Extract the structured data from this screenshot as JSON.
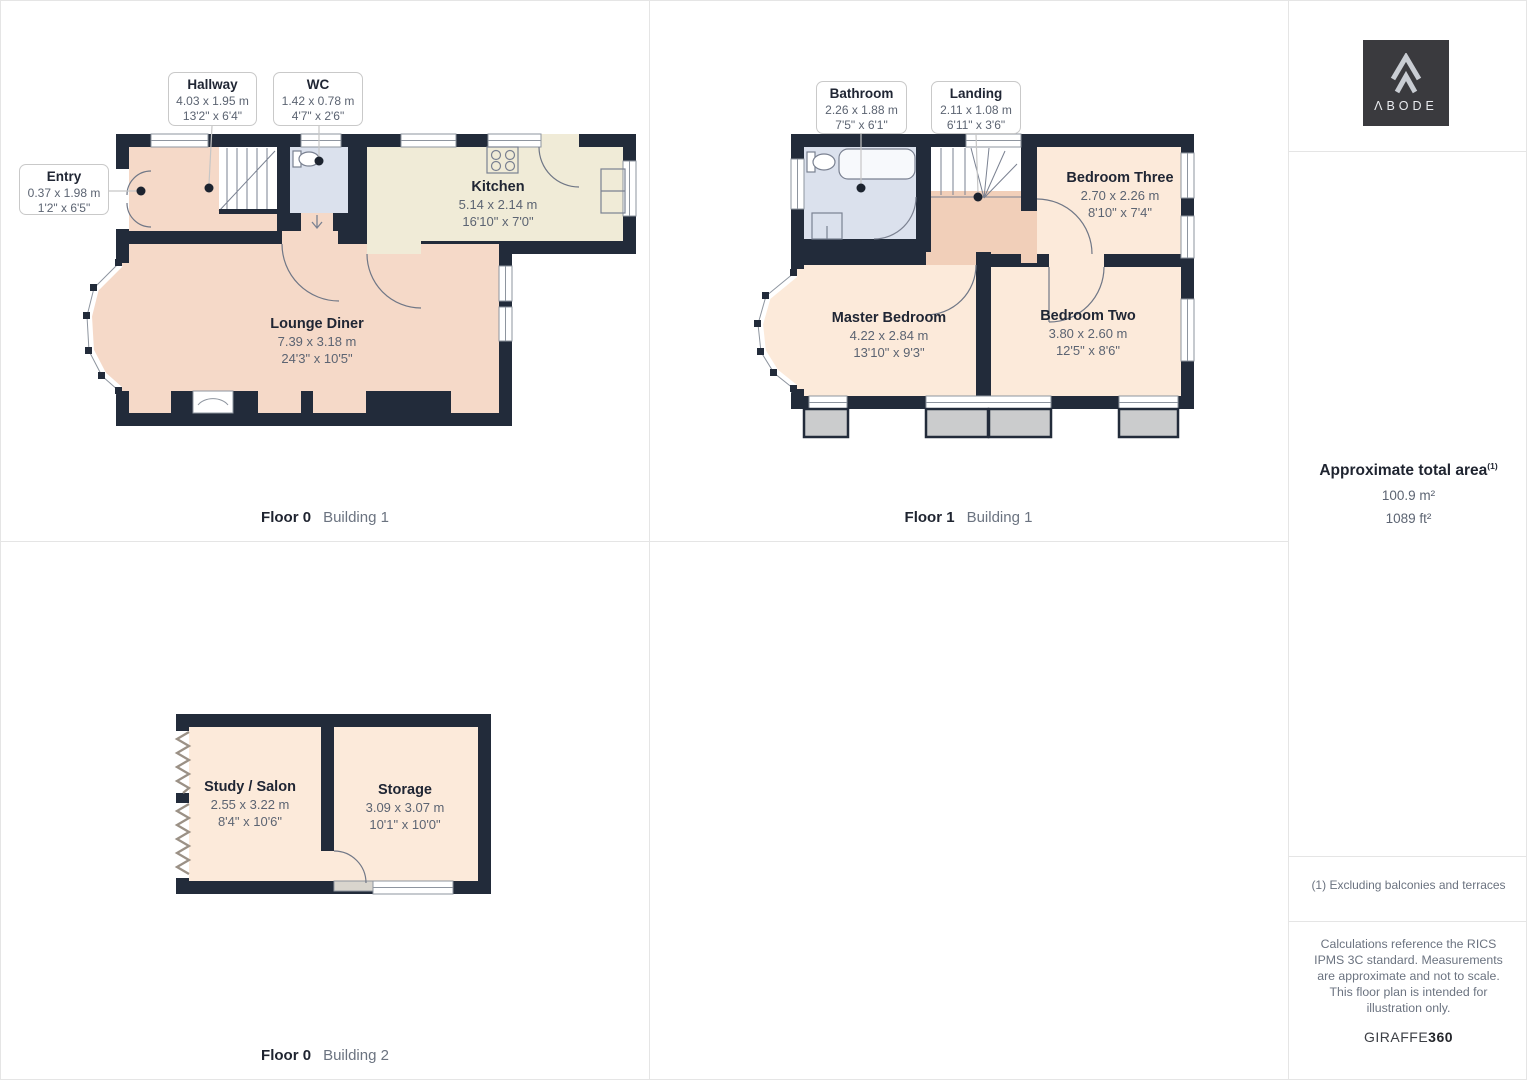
{
  "page": {
    "background": "#ffffff",
    "grid_color": "#e5e5e5"
  },
  "colors": {
    "wall": "#222b3a",
    "room_warm": "#f5d9c8",
    "room_cream": "#f0ebd7",
    "room_bedroom": "#fceada",
    "room_wet": "#dbe1ed",
    "landing": "#f1cfb9",
    "roof_grey": "#cbcccd"
  },
  "branding": {
    "logo_text": "ΛBODE",
    "footer_brand": "GIRAFFE",
    "footer_brand_bold": "360"
  },
  "sidebar": {
    "area_title": "Approximate total area",
    "area_superscript": "(1)",
    "area_m2": "100.9 m²",
    "area_ft2": "1089 ft²",
    "footnote": "(1) Excluding balconies and terraces",
    "disclaimer": "Calculations reference the RICS IPMS 3C standard. Measurements are approximate and not to scale. This floor plan is intended for illustration only."
  },
  "floors": [
    {
      "caption": {
        "floor": "Floor 0",
        "building": "Building 1"
      },
      "callouts": [
        {
          "name": "Entry",
          "dim_m": "0.37 x 1.98 m",
          "dim_ft": "1'2\" x 6'5\""
        },
        {
          "name": "Hallway",
          "dim_m": "4.03 x 1.95 m",
          "dim_ft": "13'2\" x 6'4\""
        },
        {
          "name": "WC",
          "dim_m": "1.42 x 0.78 m",
          "dim_ft": "4'7\" x 2'6\""
        }
      ],
      "rooms": [
        {
          "name": "Kitchen",
          "dim_m": "5.14 x 2.14 m",
          "dim_ft": "16'10\" x 7'0\""
        },
        {
          "name": "Lounge Diner",
          "dim_m": "7.39 x 3.18 m",
          "dim_ft": "24'3\" x 10'5\""
        }
      ]
    },
    {
      "caption": {
        "floor": "Floor 1",
        "building": "Building 1"
      },
      "callouts": [
        {
          "name": "Bathroom",
          "dim_m": "2.26 x 1.88 m",
          "dim_ft": "7'5\" x 6'1\""
        },
        {
          "name": "Landing",
          "dim_m": "2.11 x 1.08 m",
          "dim_ft": "6'11\" x 3'6\""
        }
      ],
      "rooms": [
        {
          "name": "Bedroom Three",
          "dim_m": "2.70 x 2.26 m",
          "dim_ft": "8'10\" x 7'4\""
        },
        {
          "name": "Master Bedroom",
          "dim_m": "4.22 x 2.84 m",
          "dim_ft": "13'10\" x 9'3\""
        },
        {
          "name": "Bedroom Two",
          "dim_m": "3.80 x 2.60 m",
          "dim_ft": "12'5\" x 8'6\""
        }
      ]
    },
    {
      "caption": {
        "floor": "Floor 0",
        "building": "Building 2"
      },
      "rooms": [
        {
          "name": "Study / Salon",
          "dim_m": "2.55 x 3.22 m",
          "dim_ft": "8'4\" x 10'6\""
        },
        {
          "name": "Storage",
          "dim_m": "3.09 x 3.07 m",
          "dim_ft": "10'1\" x 10'0\""
        }
      ]
    }
  ]
}
